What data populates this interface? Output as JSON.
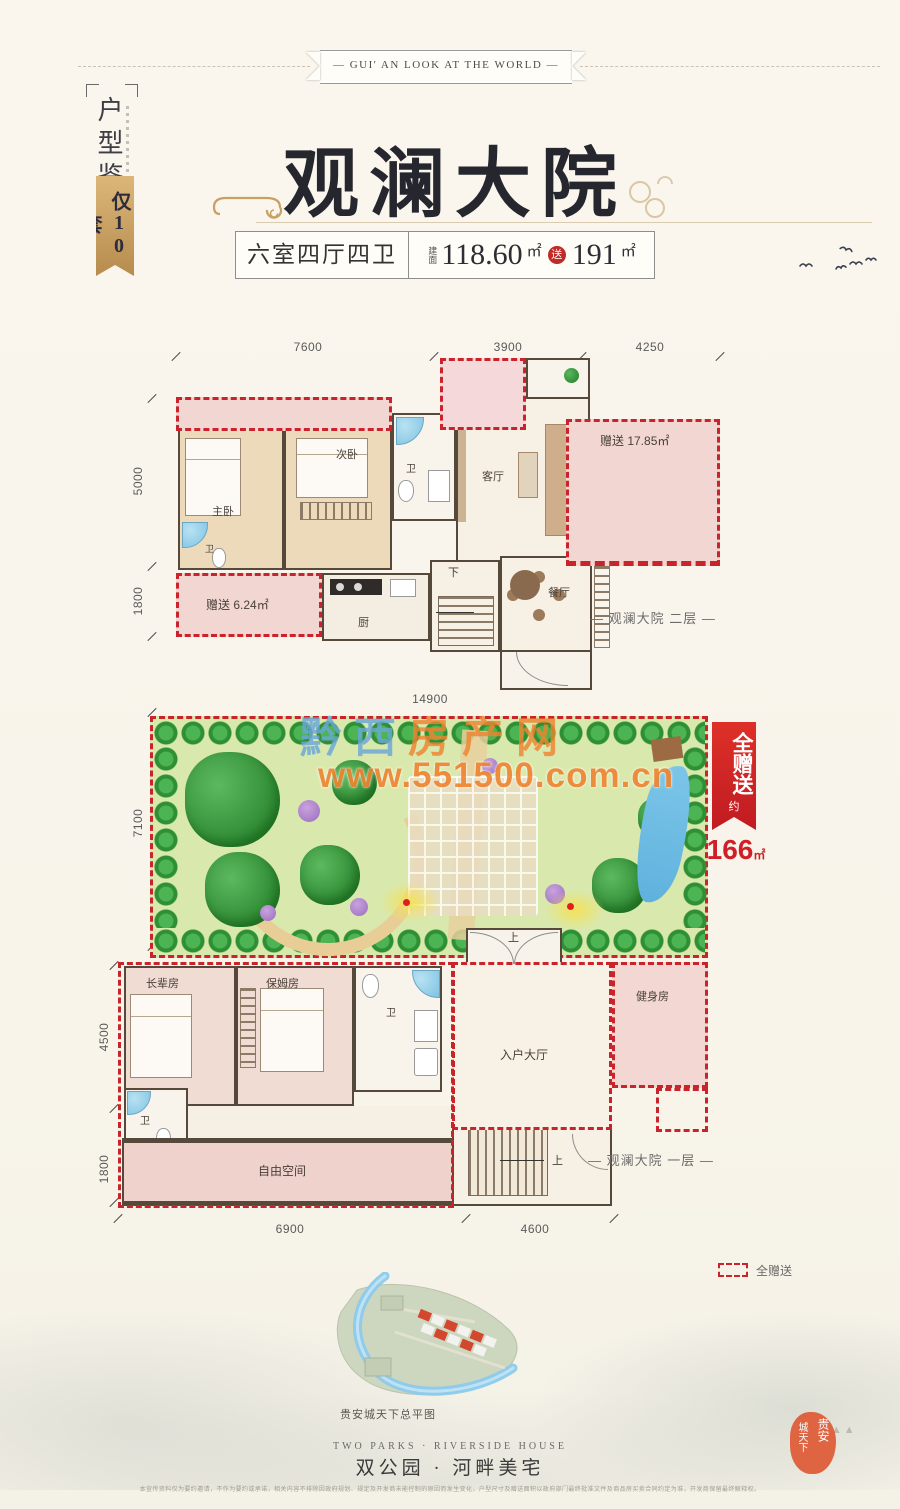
{
  "banner": {
    "text": "— GUI' AN LOOK AT THE WORLD —"
  },
  "side": {
    "title": "户型鉴赏",
    "badge": "仅10套"
  },
  "header": {
    "title": "观澜大院",
    "spec": "六室四厅四卫",
    "area_label": "建面",
    "area": "118.60",
    "area_unit": "㎡",
    "gift_label": "送",
    "gift_area": "191",
    "gift_unit": "㎡"
  },
  "floor2": {
    "caption": "— 观澜大院 二层 —",
    "dims": {
      "top_left": "7600",
      "top_mid": "3900",
      "top_right": "4250",
      "left_upper": "5000",
      "left_lower": "1800"
    },
    "rooms": {
      "master": "主卧",
      "second": "次卧",
      "bath_a": "卫",
      "bath_b": "卫",
      "living": "客厅",
      "dining": "餐厅",
      "kitchen": "厨",
      "stairs": "下"
    },
    "gifts": {
      "room_right": "赠送 17.85㎡",
      "room_left": "赠送 6.24㎡"
    }
  },
  "garden": {
    "dims": {
      "top": "14900",
      "left": "7100"
    },
    "badge": {
      "line": "全赠送",
      "approx": "约",
      "value": "166",
      "unit": "㎡"
    },
    "watermark": {
      "name_blue": "黔西",
      "name_orange": "房产网",
      "url": "www.551500.com.cn"
    }
  },
  "floor1": {
    "caption": "— 观澜大院 一层 —",
    "dims": {
      "left_upper": "4500",
      "left_lower": "1800",
      "bottom_left": "6900",
      "bottom_right": "4600"
    },
    "rooms": {
      "elder": "长辈房",
      "nanny": "保姆房",
      "bath1": "卫",
      "bath2": "卫",
      "gym": "健身房",
      "hall": "入户大厅",
      "free": "自由空间",
      "stairs_up": "上"
    }
  },
  "legend": {
    "gift": "全赠送"
  },
  "footer": {
    "map_caption": "贵安城天下总平图",
    "slogan_en": "TWO PARKS · RIVERSIDE HOUSE",
    "slogan_cn": "双公园 · 河畔美宅",
    "seal_col1": "贵安",
    "seal_col2": "城天下",
    "disclaimer": "本宣传资料仅为要约邀请，不作为要约或承诺，相关内容不排除因政府规划、规定及开发商未能控制的原因而发生变化，户型尺寸及赠送面积以政府部门最终批准文件及商品房买卖合同约定为准，开发商保留最终解释权。"
  },
  "colors": {
    "accent_red": "#c9242b",
    "gold": "#c9a063",
    "wall": "#55493c"
  }
}
